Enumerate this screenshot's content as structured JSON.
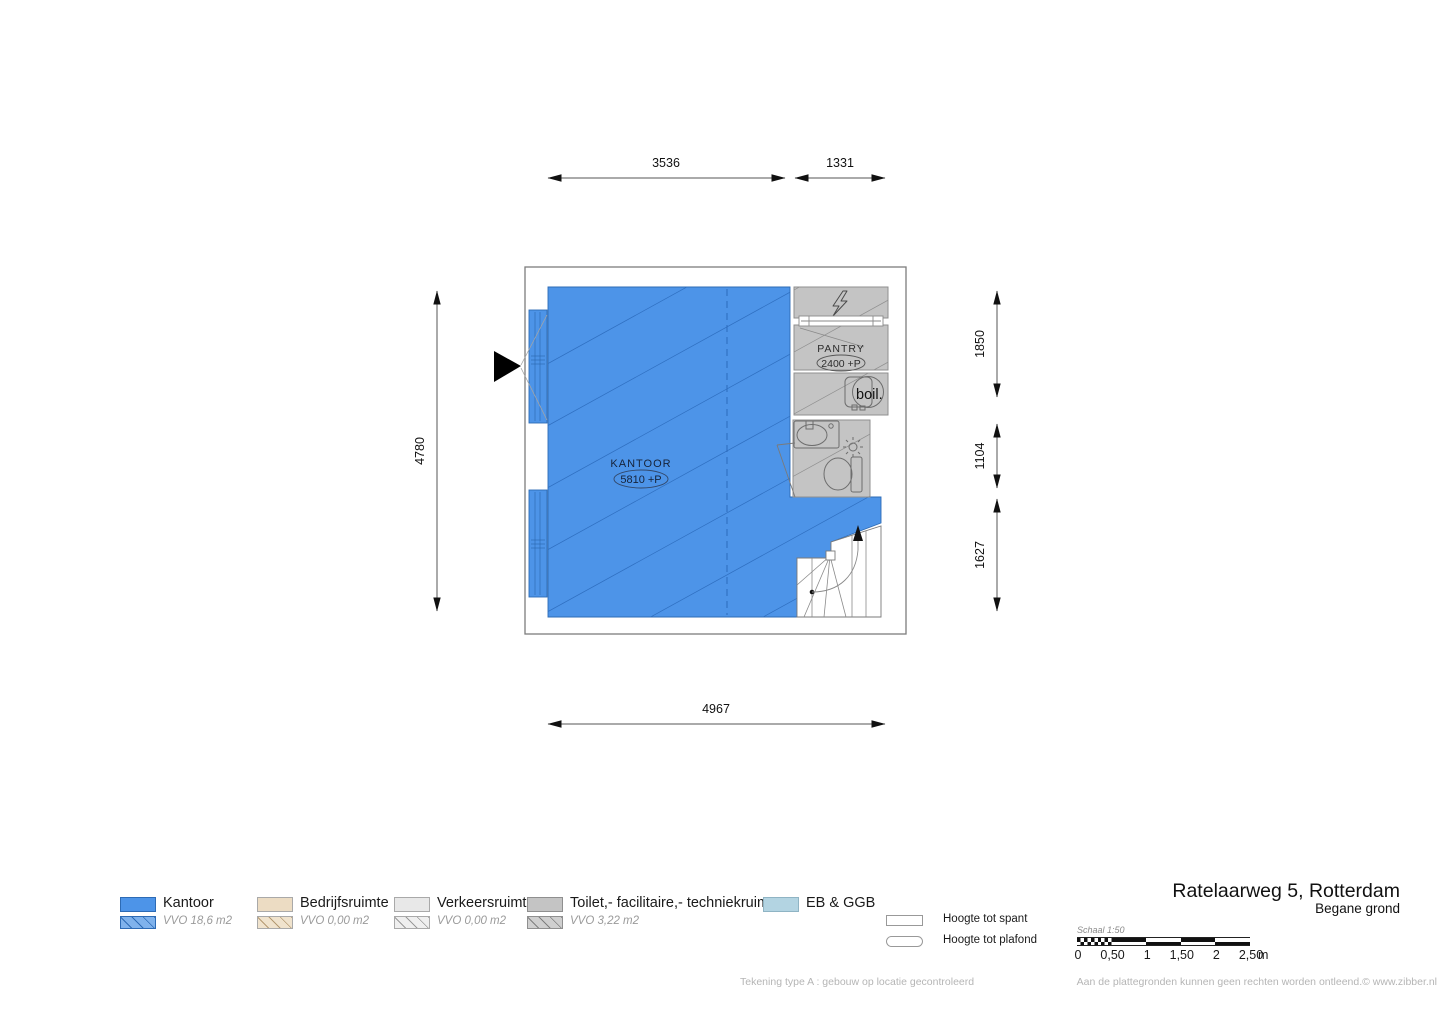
{
  "title": {
    "address": "Ratelaarweg 5, Rotterdam",
    "floor": "Begane grond"
  },
  "dimensions": {
    "top_left": "3536",
    "top_right": "1331",
    "left": "4780",
    "right_top": "1850",
    "right_middle": "1104",
    "right_bottom": "1627",
    "bottom": "4967"
  },
  "rooms": {
    "kantoor": {
      "label": "KANTOOR",
      "height": "5810 +P"
    },
    "pantry": {
      "label": "PANTRY",
      "height": "2400 +P"
    },
    "boiler": {
      "label": "boil."
    }
  },
  "legend": {
    "items": [
      {
        "label": "Kantoor",
        "vvo": "VVO 18,6 m2",
        "color": "#4d94e8"
      },
      {
        "label": "Bedrijfsruimte",
        "vvo": "VVO 0,00 m2",
        "color": "#ecdcc3"
      },
      {
        "label": "Verkeersruimte",
        "vvo": "VVO 0,00  m2",
        "color": "#e8e8e8"
      },
      {
        "label": "Toilet,- facilitaire,- techniekruimte",
        "vvo": "VVO 3,22  m2",
        "color": "#c4c4c4"
      },
      {
        "label": "EB & GGB",
        "color": "#b3d4e2"
      }
    ],
    "height_markers": [
      {
        "label": "Hoogte tot spant"
      },
      {
        "label": "Hoogte tot plafond"
      }
    ]
  },
  "scalebar": {
    "label": "Schaal 1:50",
    "ticks": [
      "0",
      "0,50",
      "1",
      "1,50",
      "2",
      "2,50"
    ],
    "unit": "m"
  },
  "footer": {
    "left": "Tekening type A : gebouw op locatie gecontroleerd",
    "right": "Aan de plattegronden kunnen geen rechten worden ontleend.© www.zibber.nl"
  },
  "colors": {
    "kantoor_fill": "#4d94e8",
    "kantoor_hatch": "#2d6bb5",
    "techniek_fill": "#c4c4c4",
    "wall_outline": "#7d7d7d",
    "dimension_ink": "#111111"
  }
}
